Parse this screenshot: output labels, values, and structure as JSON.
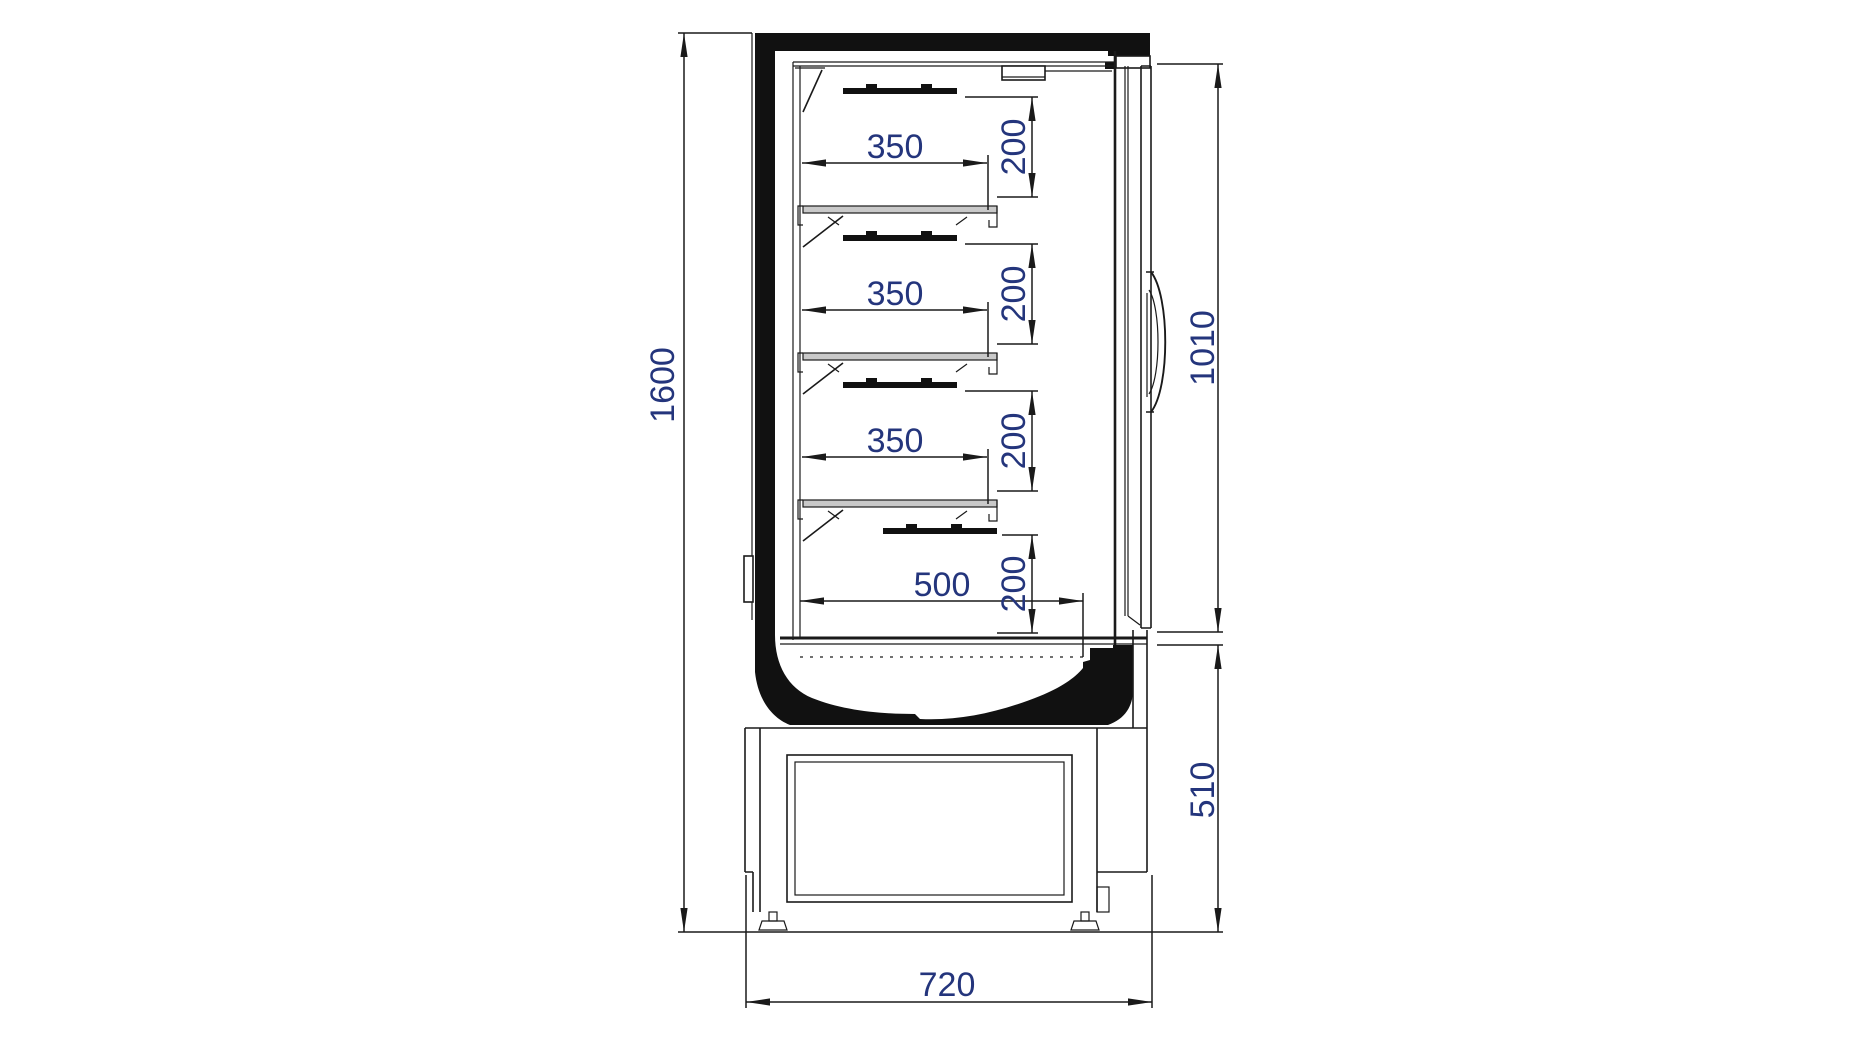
{
  "drawing": {
    "view": "side-section",
    "dimensions": {
      "overall_height": "1600",
      "overall_depth": "720",
      "opening_height": "1010",
      "base_height": "510",
      "bottom_shelf_depth": "500",
      "shelf_depths": [
        "350",
        "350",
        "350"
      ],
      "level_clearances": [
        "200",
        "200",
        "200",
        "200"
      ]
    },
    "colors": {
      "line": "#1a1a1a",
      "dimension_text": "#24357c",
      "shelf_fill": "#c9c9c9",
      "background": "#ffffff"
    }
  }
}
